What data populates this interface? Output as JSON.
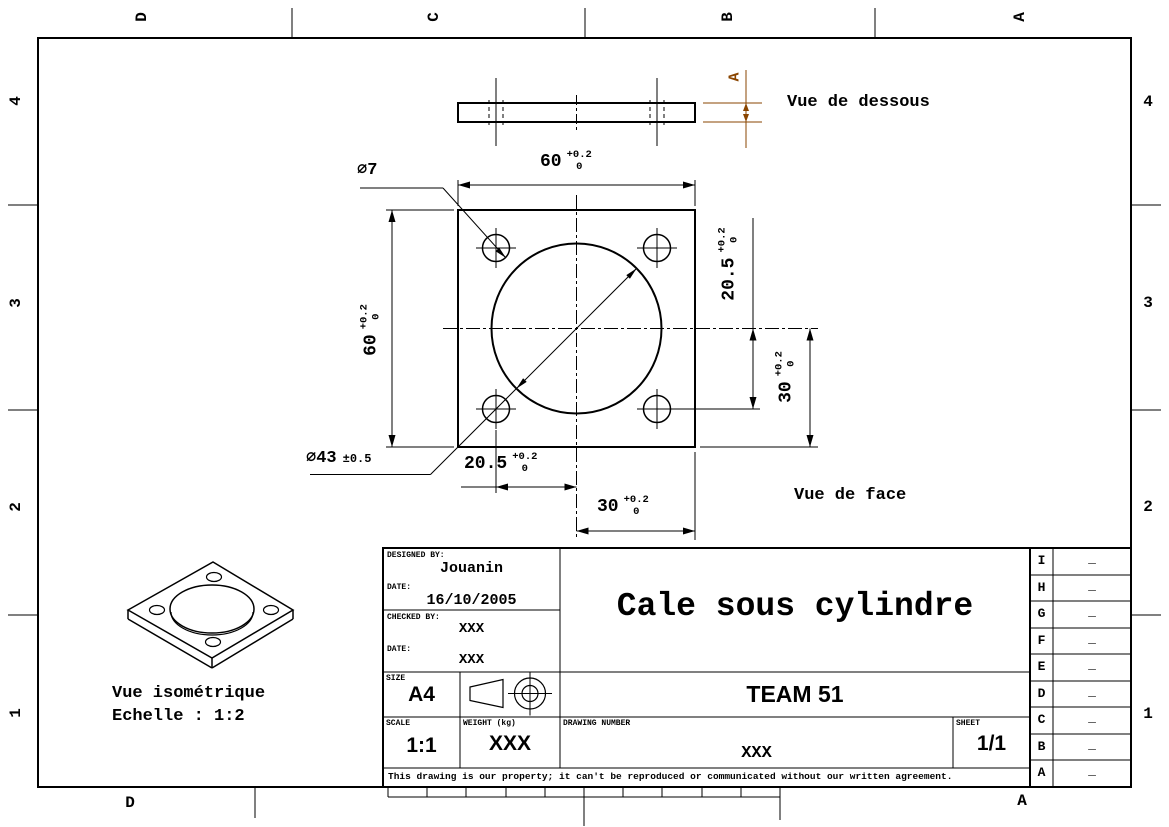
{
  "colors": {
    "line": "#000000",
    "section_mark": "#8a4500",
    "background": "#ffffff"
  },
  "zones": {
    "top": [
      "D",
      "C",
      "B",
      "A"
    ],
    "bottom": [
      "D",
      "A"
    ],
    "left": [
      "4",
      "3",
      "2",
      "1"
    ],
    "right": [
      "4",
      "3",
      "2",
      "1"
    ]
  },
  "views": {
    "bottom_view": {
      "label": "Vue de dessous",
      "section_mark": "A"
    },
    "front_view": {
      "label": "Vue de face"
    },
    "iso_view": {
      "label": "Vue isométrique",
      "scale_note": "Echelle :  1:2"
    }
  },
  "dimensions": {
    "overall_width": {
      "value": "60",
      "tol_plus": "+0.2",
      "tol_minus": "0"
    },
    "overall_height": {
      "value": "60",
      "tol_plus": "+0.2",
      "tol_minus": "0"
    },
    "hole_offset_x": {
      "value": "20.5",
      "tol_plus": "+0.2",
      "tol_minus": "0"
    },
    "hole_offset_y": {
      "value": "20.5",
      "tol_plus": "+0.2",
      "tol_minus": "0"
    },
    "center_to_edge_x": {
      "value": "30",
      "tol_plus": "+0.2",
      "tol_minus": "0"
    },
    "center_to_edge_y": {
      "value": "30",
      "tol_plus": "+0.2",
      "tol_minus": "0"
    },
    "small_hole": {
      "value": "⌀7"
    },
    "center_hole": {
      "value": "⌀43",
      "tolerance": "±0.5"
    }
  },
  "title_block": {
    "designed_by_label": "DESIGNED BY:",
    "designed_by": "Jouanin",
    "designed_date_label": "DATE:",
    "designed_date": "16/10/2005",
    "checked_by_label": "CHECKED BY:",
    "checked_by": "XXX",
    "checked_date_label": "DATE:",
    "checked_date": "XXX",
    "size_label": "SIZE",
    "size": "A4",
    "scale_label": "SCALE",
    "scale": "1:1",
    "weight_label": "WEIGHT (kg)",
    "weight": "XXX",
    "drawing_number_label": "DRAWING NUMBER",
    "drawing_number": "XXX",
    "sheet_label": "SHEET",
    "sheet": "1/1",
    "title": "Cale sous cylindre",
    "subtitle": "TEAM 51",
    "disclaimer": "This drawing is our property; it can't be reproduced or communicated without our written agreement.",
    "revisions": [
      {
        "letter": "I",
        "value": "_"
      },
      {
        "letter": "H",
        "value": "_"
      },
      {
        "letter": "G",
        "value": "_"
      },
      {
        "letter": "F",
        "value": "_"
      },
      {
        "letter": "E",
        "value": "_"
      },
      {
        "letter": "D",
        "value": "_"
      },
      {
        "letter": "C",
        "value": "_"
      },
      {
        "letter": "B",
        "value": "_"
      },
      {
        "letter": "A",
        "value": "_"
      }
    ]
  }
}
